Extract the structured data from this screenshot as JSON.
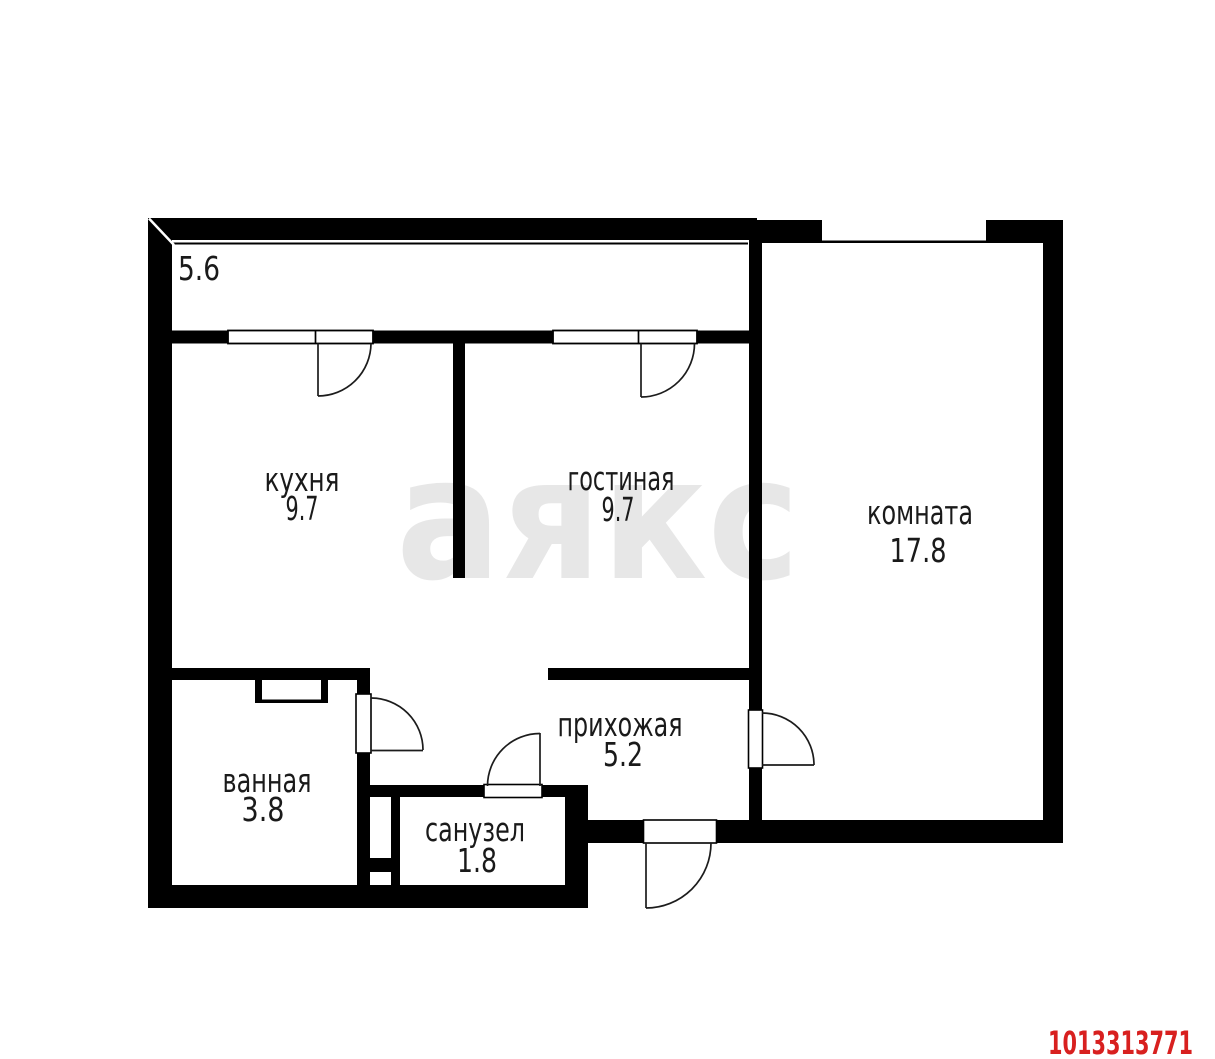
{
  "plan": {
    "balcony": {
      "area": "5.6"
    },
    "kitchen": {
      "name": "кухня",
      "area": "9.7"
    },
    "living_room": {
      "name": "гостиная",
      "area": "9.7"
    },
    "room": {
      "name": "комната",
      "area": "17.8"
    },
    "bathroom": {
      "name": "ванная",
      "area": "3.8"
    },
    "wc": {
      "name": "санузел",
      "area": "1.8"
    },
    "hallway": {
      "name": "прихожая",
      "area": "5.2"
    }
  },
  "watermark": {
    "text": "аякс",
    "color": "#e7e7e7"
  },
  "listing_id": {
    "value": "1013313771",
    "color": "#d8201f"
  },
  "colors": {
    "wall": "#000000",
    "background": "#ffffff",
    "label": "#1a1a1a"
  }
}
